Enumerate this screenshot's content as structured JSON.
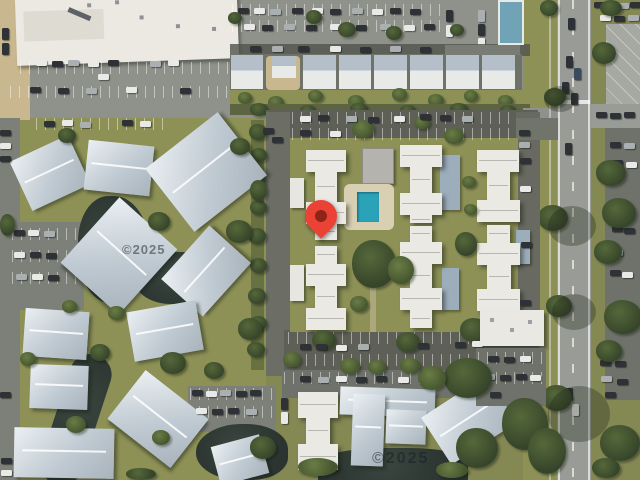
{
  "map": {
    "type": "satellite",
    "marker": {
      "icon": "location-pin-icon",
      "color": "#EA4335",
      "dot_color": "#8E2318",
      "pin_tip_position": {
        "x": 321,
        "y": 239
      }
    },
    "watermarks": [
      {
        "text": "©2025"
      },
      {
        "text": "©2025"
      }
    ],
    "features": {
      "pool_color": "#2AA2B8",
      "water_color": "#2F3A36",
      "grass_color": "#8D9156",
      "road_color": "#999C96",
      "roof_white": "#ECEAE4",
      "roof_blue_gray": "#BCC7CF",
      "teal_roof": "#6FA3B5"
    }
  }
}
